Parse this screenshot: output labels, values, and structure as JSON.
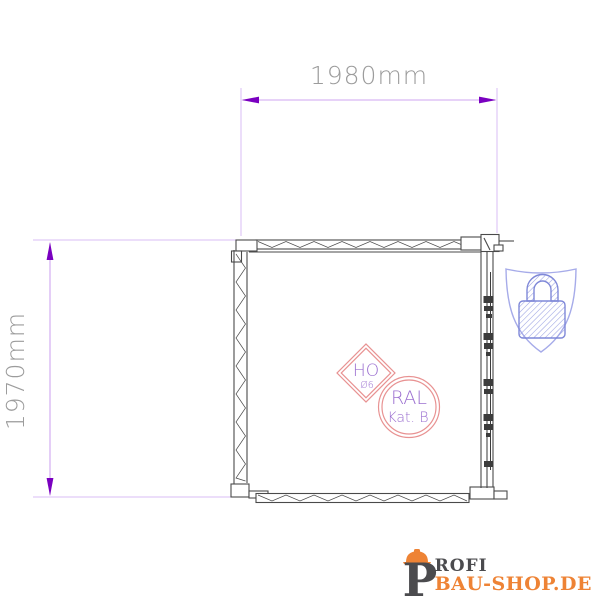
{
  "page": {
    "background": "#ffffff",
    "description": "Technical line drawing of a 1980mm x 1970mm door/shed unit with certification stamps, security badge and shop watermark"
  },
  "drawing": {
    "width_dimension": "1980mm",
    "height_dimension": "1970mm"
  },
  "stamps": {
    "diamond": {
      "top": "HO",
      "bottom": "Ø6"
    },
    "circle": {
      "top": "RAL",
      "bottom": "Kat. B"
    }
  },
  "icons": {
    "security_badge": "shield-padlock-icon",
    "logo_helmet": "hard-hat-icon"
  },
  "logo": {
    "initial": "P",
    "rest": "ROFI",
    "domain": "BAU-SHOP.DE"
  },
  "colors": {
    "background": "#ffffff",
    "dim-line": "#cfa6f0",
    "dim-ext": "#d9bcf4",
    "dim-arrow": "#7a00c0",
    "dim-text": "#9c9c9c",
    "line": "#4a4a4a",
    "hardware": "#3c3c3c",
    "stamp-ring": "#e89292",
    "stamp-text": "#9b6fd0",
    "shield-line": "#a6abe9",
    "lock-line": "#7f88d8",
    "logo-dark": "#4b4b4e",
    "logo-orange": "#ee8335"
  }
}
